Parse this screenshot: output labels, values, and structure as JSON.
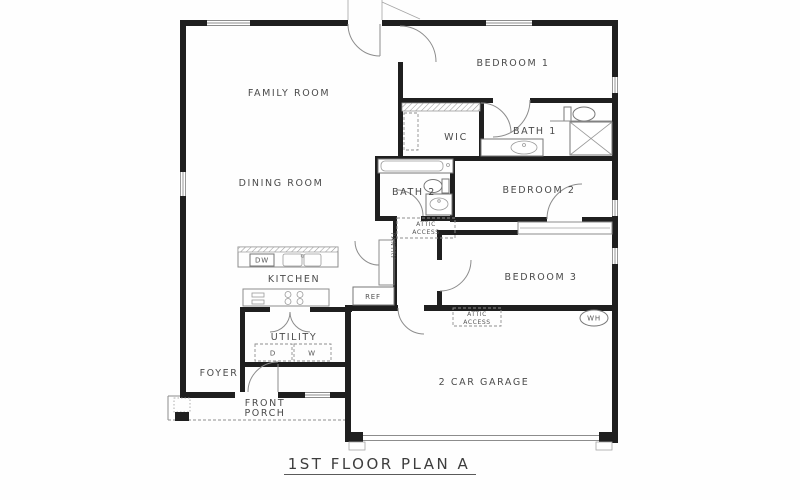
{
  "title": "1ST FLOOR PLAN A",
  "rooms": {
    "family_room": "FAMILY ROOM",
    "dining_room": "DINING ROOM",
    "kitchen": "KITCHEN",
    "bedroom1": "BEDROOM 1",
    "bedroom2": "BEDROOM 2",
    "bedroom3": "BEDROOM 3",
    "bath1": "BATH 1",
    "bath2": "BATH 2",
    "wic": "WIC",
    "utility": "UTILITY",
    "foyer": "FOYER",
    "front_porch_line1": "FRONT",
    "front_porch_line2": "PORCH",
    "garage": "2 CAR GARAGE",
    "pantry": "PANTRY"
  },
  "fixtures": {
    "dishwasher": "DW",
    "refrigerator": "REF",
    "dryer": "D",
    "washer": "W",
    "water_heater": "WH",
    "attic_access_line1": "ATTIC",
    "attic_access_line2": "ACCESS"
  },
  "colors": {
    "wall": "#1f1f1f",
    "thin_line": "#8c8c8c",
    "label_text": "#4b4b4b",
    "background": "#fefefe"
  }
}
